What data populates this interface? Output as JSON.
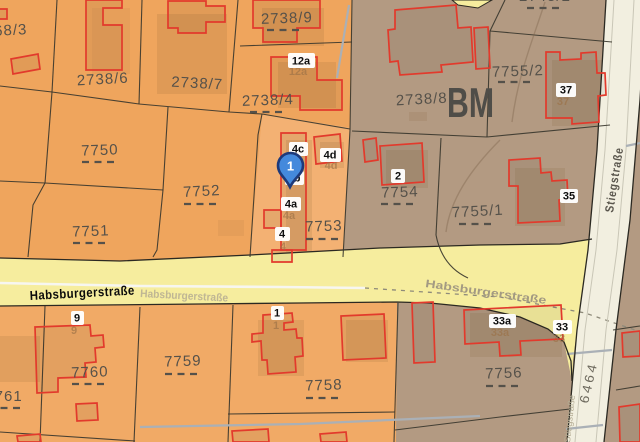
{
  "map": {
    "area_label": "BM",
    "marker": {
      "label": "1"
    },
    "streets": {
      "habsburger_main": "Habsburgerstraße",
      "habsburger_road_left": "Habsburgerstraße",
      "habsburger_road_right": "Habsburgerstraße",
      "stieg": "Stiegstraße",
      "stieg_small": "Stiegstraße",
      "road_6464": "6464"
    },
    "parcels": {
      "p68_3": "68/3",
      "p2738_6": "2738/6",
      "p2738_7": "2738/7",
      "p2738_9": "2738/9",
      "p2738_4": "2738/4",
      "p2745_2": "2745/2",
      "p2738_8": "2738/8",
      "p7755_2": "7755/2",
      "p7750": "7750",
      "p7752": "7752",
      "p7751": "7751",
      "p7753": "7753",
      "p7754": "7754",
      "p7755_1": "7755/1",
      "p7761": "7761",
      "p7760": "7760",
      "p7759": "7759",
      "p7758": "7758",
      "p7756": "7756"
    },
    "buildings": {
      "b12a": "12a",
      "b4c": "4c",
      "b4b": "4b",
      "b4a": "4a",
      "b4": "4",
      "b4d": "4d",
      "b2": "2",
      "b37": "37",
      "b35": "35",
      "b33a": "33a",
      "b33": "33",
      "b1": "1",
      "b9": "9"
    },
    "colors": {
      "orange_base": "#efa55d",
      "orange_alt": "#f3b173",
      "orange_bottom": "#f1aa66",
      "brown": "#b39a82",
      "road_yellow": "#f6ed9e",
      "road_white": "#f2efe0",
      "building_red": "#e23a2c",
      "marker_fill": "#4489dc",
      "marker_stroke": "#1e3a7a"
    }
  }
}
